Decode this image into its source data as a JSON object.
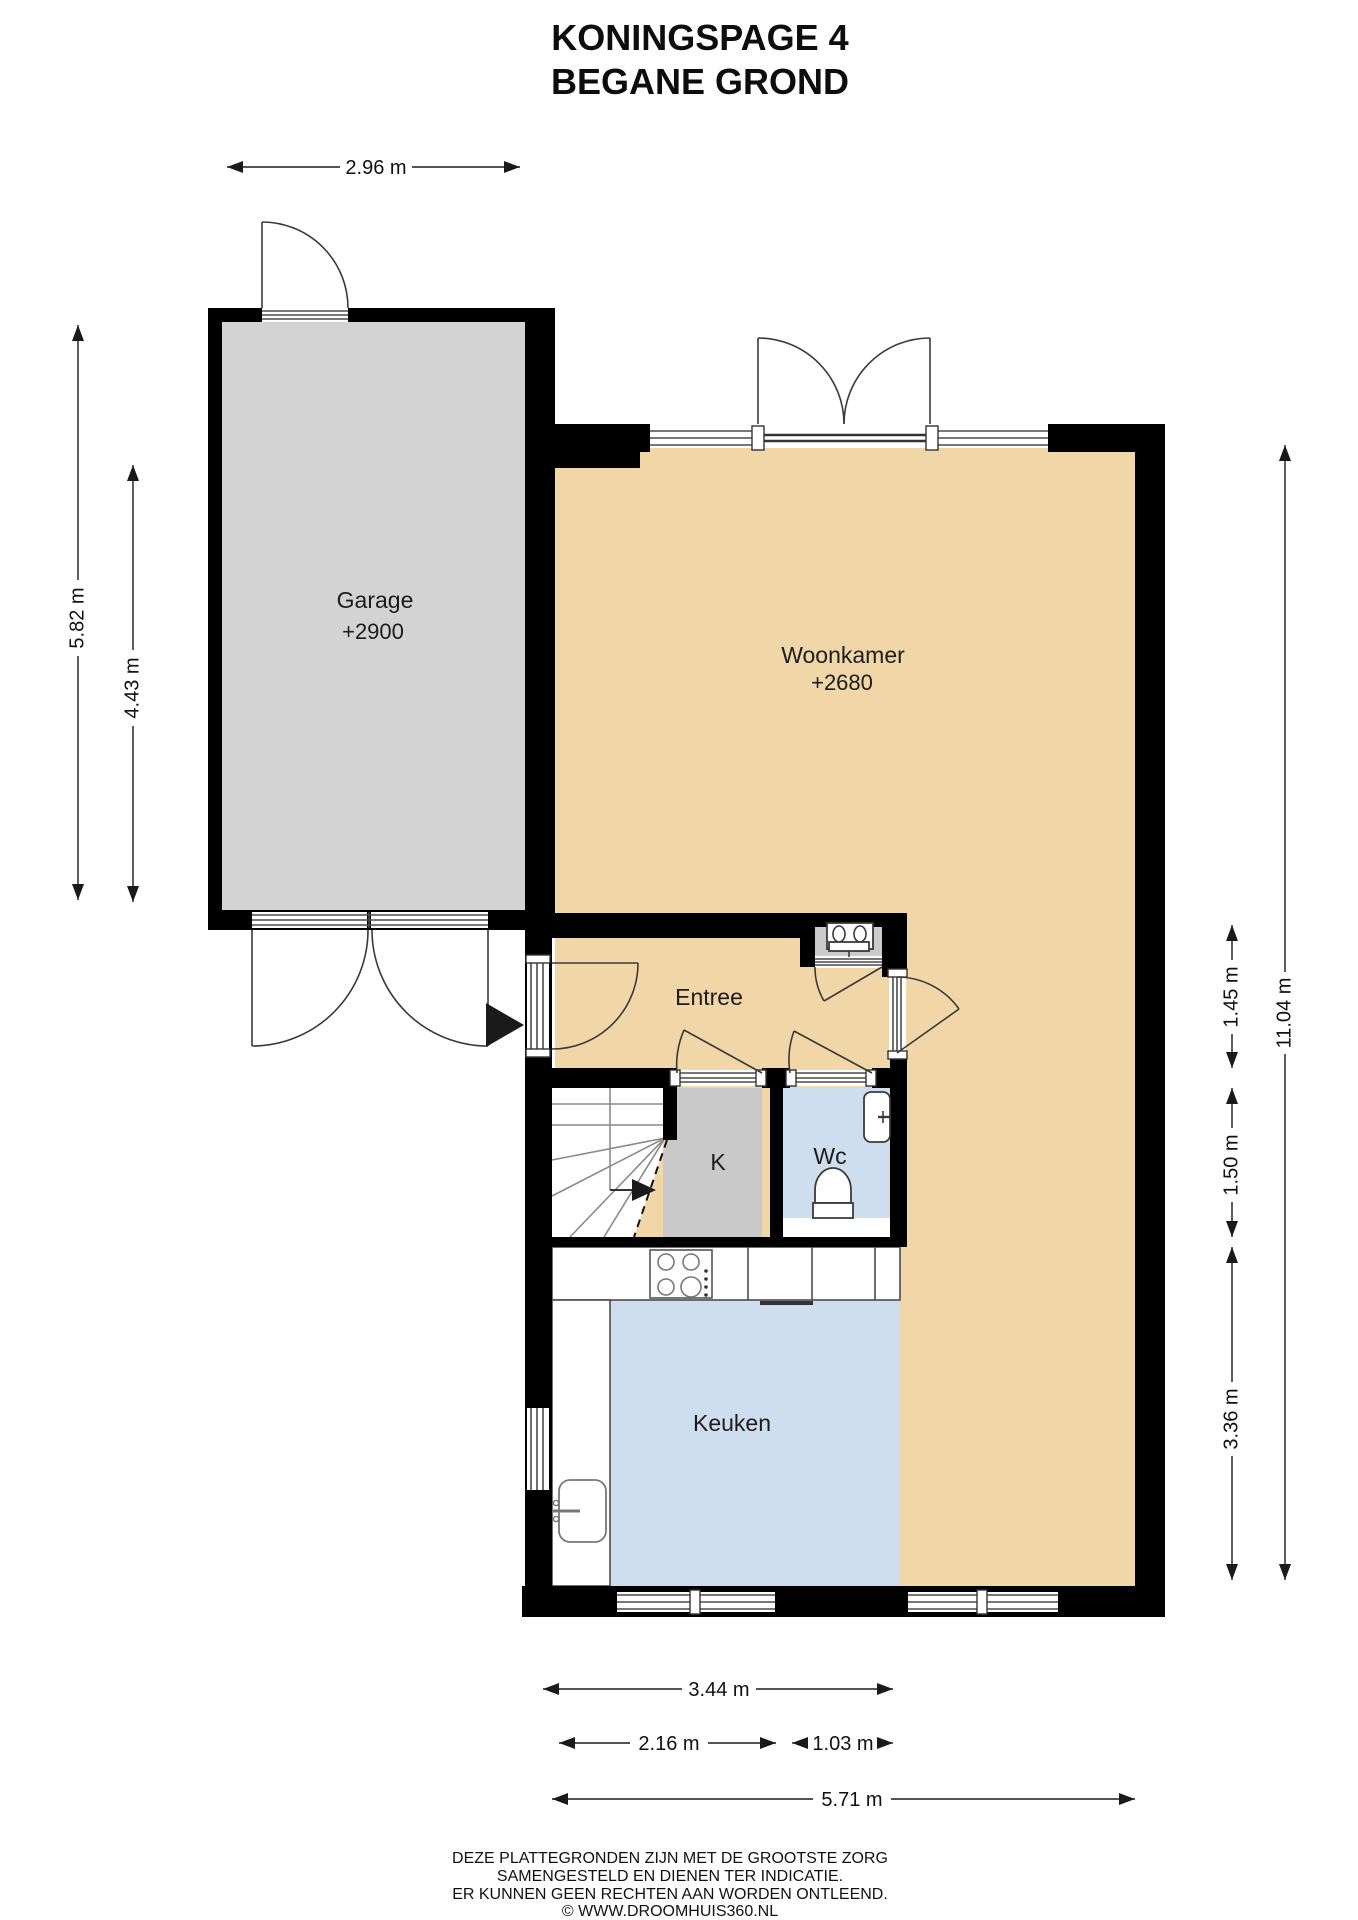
{
  "title": {
    "line1": "KONINGSPAGE 4",
    "line2": "BEGANE GROND"
  },
  "rooms": {
    "garage": {
      "name": "Garage",
      "level": "+2900"
    },
    "woonkamer": {
      "name": "Woonkamer",
      "level": "+2680"
    },
    "entree": {
      "name": "Entree"
    },
    "closet": {
      "name": "K"
    },
    "wc": {
      "name": "Wc"
    },
    "keuken": {
      "name": "Keuken"
    }
  },
  "dimensions": {
    "top": [
      "2.96 m"
    ],
    "left": [
      "5.82 m",
      "4.43 m"
    ],
    "right": [
      "1.45 m",
      "1.50 m",
      "3.36 m",
      "11.04 m"
    ],
    "bottom": [
      "3.44 m",
      "2.16 m",
      "1.03 m",
      "5.71 m"
    ]
  },
  "footer": {
    "line1": "DEZE PLATTEGRONDEN ZIJN MET DE GROOTSTE ZORG",
    "line2": "SAMENGESTELD EN DIENEN TER INDICATIE.",
    "line3": "ER KUNNEN GEEN RECHTEN AAN WORDEN ONTLEEND.",
    "line4": "© WWW.DROOMHUIS360.NL"
  },
  "colors": {
    "wall": "#000000",
    "garage_floor": "#D3D3D3",
    "living_floor": "#F1D7A8",
    "closet_floor": "#C9C9C9",
    "niche_floor": "#CBCBCB",
    "wet_floor": "#CEDEEE",
    "background": "#FFFFFF"
  }
}
